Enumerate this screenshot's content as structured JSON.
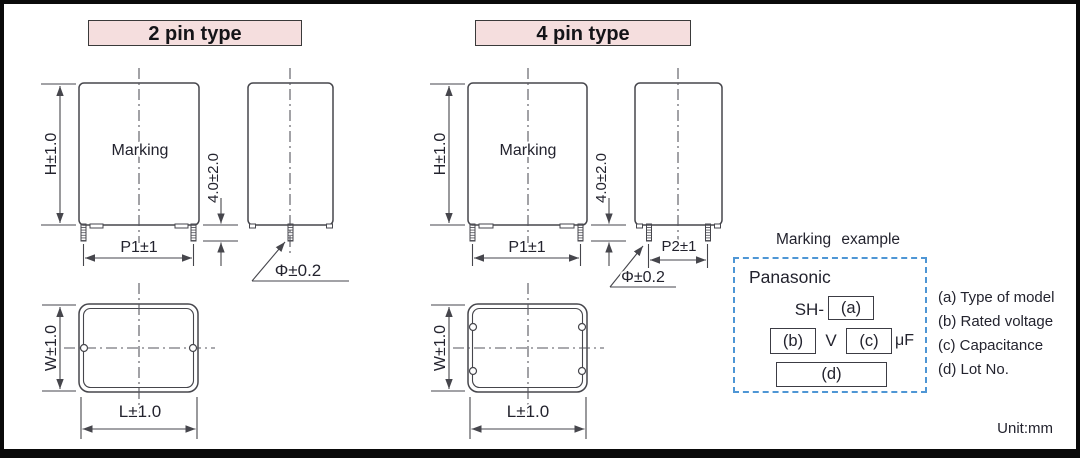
{
  "sections": {
    "two_pin": {
      "title": "2 pin type"
    },
    "four_pin": {
      "title": "4 pin type"
    }
  },
  "dimensions": {
    "marking": "Marking",
    "height": "H±1.0",
    "lead_length": "4.0±2.0",
    "pitch1": "P1±1",
    "pitch2": "P2±1",
    "lead_diameter": "Φ±0.2",
    "width": "W±1.0",
    "length": "L±1.0"
  },
  "marking_example": {
    "title": "Marking example",
    "brand": "Panasonic",
    "model_prefix": "SH-",
    "field_a": "(a)",
    "field_b": "(b)",
    "voltage_unit": "V",
    "field_c": "(c)",
    "capacitance_unit": "μF",
    "field_d": "(d)",
    "legend": [
      {
        "label": "(a) Type of model"
      },
      {
        "label": "(b) Rated voltage"
      },
      {
        "label": "(c) Capacitance"
      },
      {
        "label": "(d) Lot No."
      }
    ]
  },
  "footer": {
    "unit_label": "Unit:mm"
  },
  "colors": {
    "header_bg": "#f5dede",
    "marking_box_border": "#4e96d5",
    "line": "#46464c"
  }
}
